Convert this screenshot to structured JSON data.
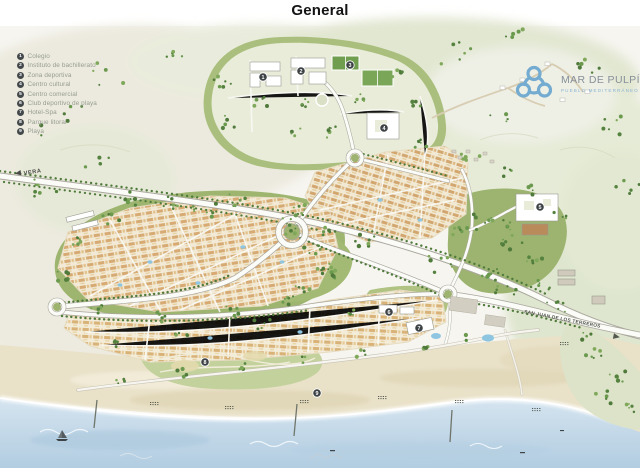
{
  "page": {
    "title": "General"
  },
  "logo": {
    "name": "MAR DE PULPÍ",
    "tagline": "PUEBLO MEDITERRÁNEO",
    "accent_color": "#74abd0"
  },
  "legend": {
    "items": [
      {
        "num": "1",
        "label": "Colegio"
      },
      {
        "num": "2",
        "label": "Instituto de bachillerato"
      },
      {
        "num": "3",
        "label": "Zona deportiva"
      },
      {
        "num": "4",
        "label": "Centro cultural"
      },
      {
        "num": "5",
        "label": "Centro comercial"
      },
      {
        "num": "6",
        "label": "Club deportivo de playa"
      },
      {
        "num": "7",
        "label": "Hotel-Spa"
      },
      {
        "num": "8",
        "label": "Parque litoral"
      },
      {
        "num": "9",
        "label": "Playa"
      }
    ]
  },
  "map": {
    "road_labels": [
      {
        "text": "VERA",
        "arrow": "left"
      },
      {
        "text": "SAN JUAN DE LOS TERREROS",
        "arrow": "right"
      }
    ],
    "markers": [
      {
        "num": "1",
        "label": "Colegio",
        "x": 263,
        "y": 77
      },
      {
        "num": "2",
        "label": "Instituto de bachillerato",
        "x": 301,
        "y": 71
      },
      {
        "num": "3",
        "label": "Zona deportiva",
        "x": 350,
        "y": 65
      },
      {
        "num": "4",
        "label": "Centro cultural",
        "x": 384,
        "y": 128
      },
      {
        "num": "5",
        "label": "Centro comercial",
        "x": 540,
        "y": 207
      },
      {
        "num": "6",
        "label": "Club deportivo de playa",
        "x": 389,
        "y": 312
      },
      {
        "num": "7",
        "label": "Hotel-Spa",
        "x": 419,
        "y": 328
      },
      {
        "num": "8",
        "label": "Parque litoral",
        "x": 205,
        "y": 362
      },
      {
        "num": "9",
        "label": "Playa",
        "x": 317,
        "y": 393
      }
    ],
    "colors": {
      "sea": "#c7dbea",
      "sand": "#e9e1c8",
      "greenbelt": "#9db56f",
      "road": "#fbfbf8",
      "marker_bg": "#3d4245"
    }
  }
}
